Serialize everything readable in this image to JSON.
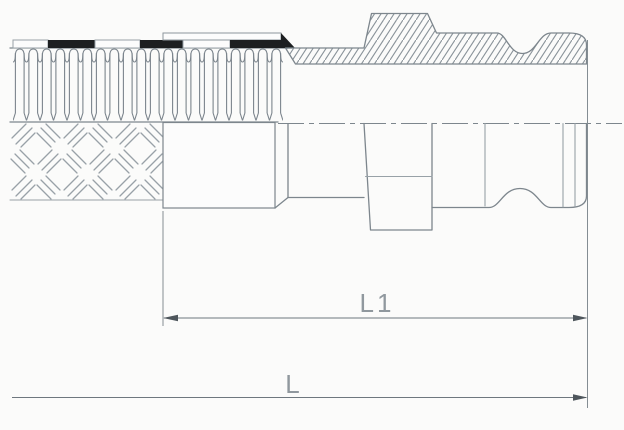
{
  "drawing": {
    "type": "technical-drawing-hose-coupling",
    "description_parts": {
      "hose_corrugation": "corrugated hose section (upper half)",
      "hose_braid": "braided hose cover (lower half outside view)",
      "ferrule": "crimp ferrule sleeve",
      "adapter": "cam-groove male adapter, upper half in hatched cross-section"
    },
    "labels": {
      "l1": "L1",
      "l": "L"
    },
    "colors": {
      "background": "#fbfbfa",
      "outline": "#7d868d",
      "outline_light": "#98a1a7",
      "hatch": "#8a939a",
      "band_black": "#1d1f21",
      "dimension_line": "#6e777e",
      "arrow": "#4e565c",
      "dimension_text": "#90989e"
    }
  }
}
